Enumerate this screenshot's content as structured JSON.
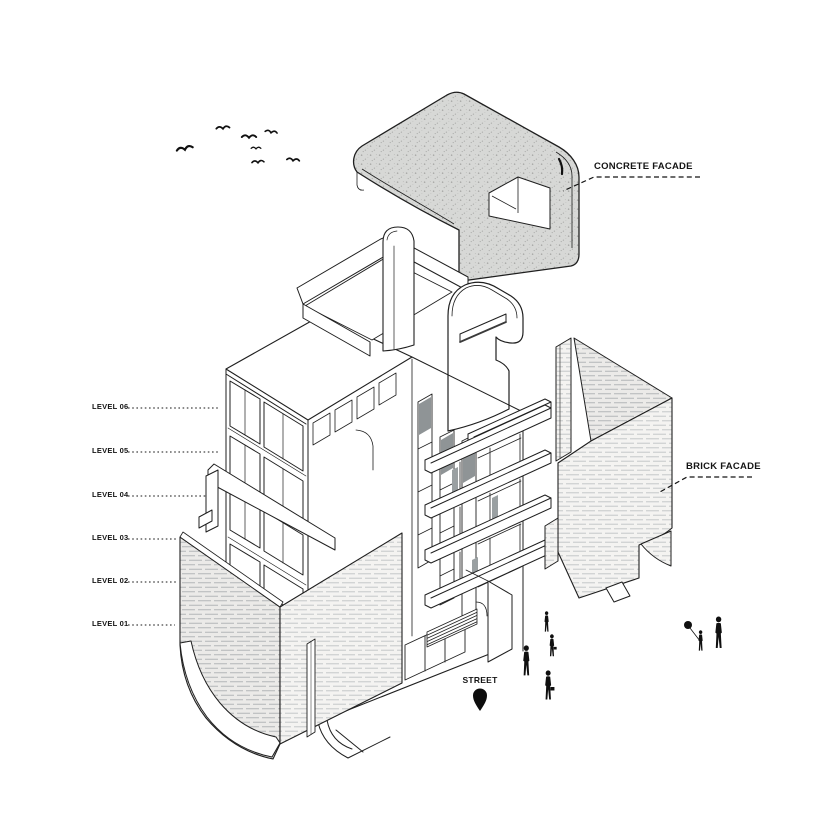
{
  "canvas": {
    "width": 837,
    "height": 837,
    "background": "#ffffff"
  },
  "colors": {
    "line": "#1f1f1f",
    "concrete_fill": "#d7d8d6",
    "concrete_dot": "#a2a3a1",
    "brick_fill_dark": "#ebeae8",
    "brick_fill_light": "#f4f3f1",
    "hatch_line": "#b3b6b8",
    "figure_black": "#101010",
    "glass_gray": "#8f9496"
  },
  "annotations": {
    "concrete": {
      "label": "CONCRETE FACADE"
    },
    "brick": {
      "label": "BRICK FACADE"
    },
    "street": {
      "label": "STREET"
    }
  },
  "levels": [
    {
      "label": "LEVEL 06"
    },
    {
      "label": "LEVEL 05"
    },
    {
      "label": "LEVEL 04"
    },
    {
      "label": "LEVEL 03"
    },
    {
      "label": "LEVEL 02"
    },
    {
      "label": "LEVEL 01"
    }
  ],
  "scene": {
    "type": "exploded-axonometric-building-diagram",
    "birds": 7,
    "pedestrians": 4,
    "family": {
      "adults": 1,
      "children": 1,
      "balloon": true
    },
    "exploded_parts": [
      "concrete facade roof shell",
      "brick facade corner wrap",
      "brick facade side panel",
      "six storey building core"
    ]
  }
}
